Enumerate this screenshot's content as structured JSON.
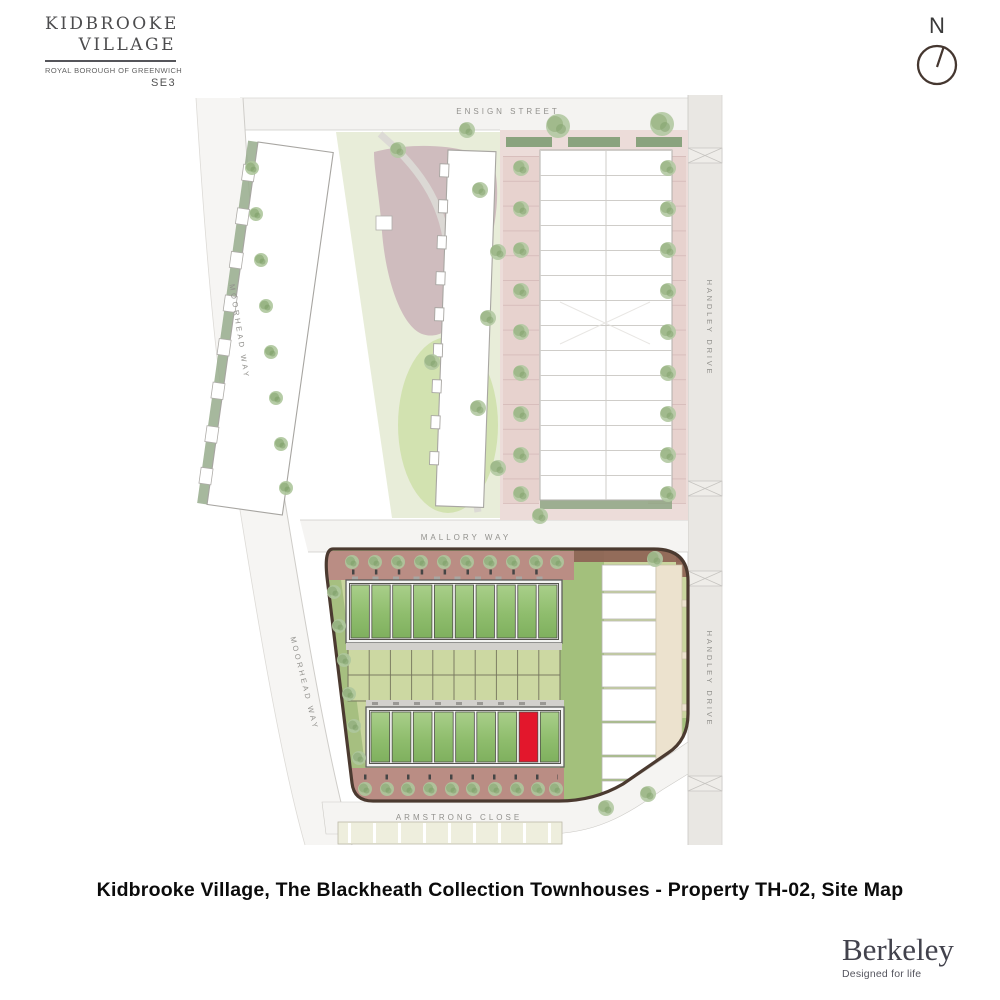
{
  "brand": {
    "name_line1": "KIDBROOKE",
    "name_line2": "VILLAGE",
    "subtitle": "ROYAL BOROUGH OF GREENWICH",
    "postcode": "SE3"
  },
  "compass": {
    "label": "N"
  },
  "map": {
    "streets": {
      "ensign": "ENSIGN STREET",
      "mallory": "MALLORY WAY",
      "armstrong": "ARMSTRONG CLOSE",
      "moorhead": "MOORHEAD WAY",
      "handley": "HANDLEY DRIVE"
    },
    "lower_block": {
      "upper_row_units": 10,
      "lower_row_units": 9,
      "highlight_unit_index": 8
    },
    "highlight": {
      "property": "TH-02",
      "color": "#e3172c"
    }
  },
  "caption": "Kidbrooke Village, The Blackheath Collection Townhouses - Property TH-02, Site Map",
  "footer": {
    "wordmark": "Berkeley",
    "tagline": "Designed for life"
  },
  "colors": {
    "highlight_red": "#e3172c",
    "roof_green_light": "#a9cf8a",
    "roof_green_dark": "#7fb05e",
    "block_border_brown": "#4b3a30",
    "parking_pink": "#ecdcd9",
    "road_gray": "#e9e7e3",
    "lawn_green": "#a3c07c",
    "brick_paving": "#ba8d84"
  }
}
